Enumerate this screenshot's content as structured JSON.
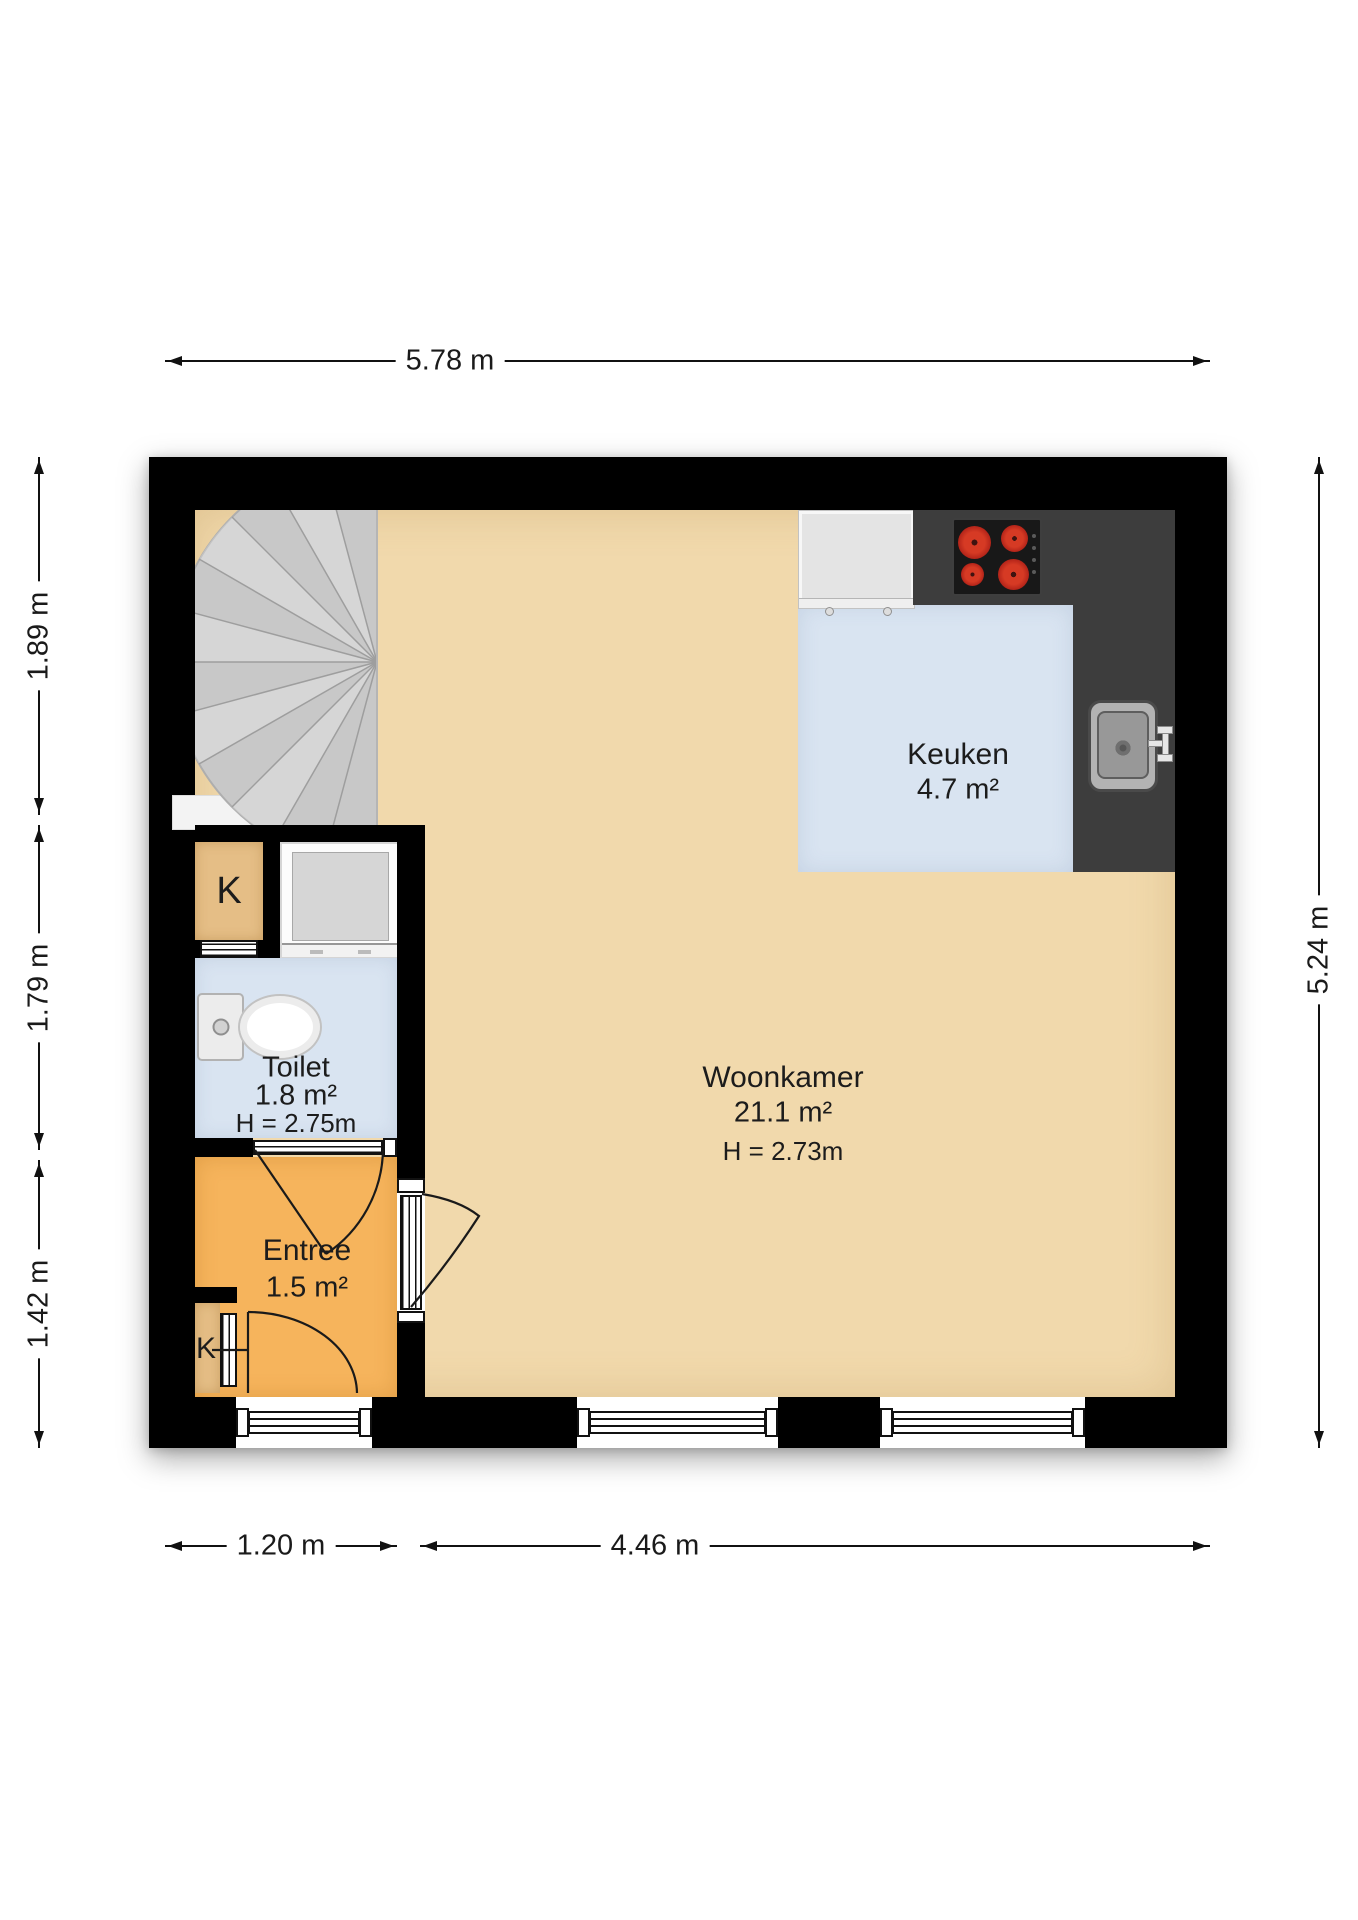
{
  "floorplan": {
    "rooms": {
      "woonkamer": {
        "name": "Woonkamer",
        "area": "21.1 m²",
        "ceiling": "H = 2.73m"
      },
      "keuken": {
        "name": "Keuken",
        "area": "4.7 m²"
      },
      "toilet": {
        "name": "Toilet",
        "area": "1.8 m²",
        "ceiling": "H = 2.75m"
      },
      "entree": {
        "name": "Entree",
        "area": "1.5 m²"
      },
      "closet": {
        "label": "K"
      },
      "meter_closet": {
        "label": "K"
      }
    },
    "dimensions": {
      "top_width": "5.78 m",
      "left_upper": "1.89 m",
      "left_middle": "1.79 m",
      "left_lower": "1.42 m",
      "right_height": "5.24 m",
      "bottom_left": "1.20 m",
      "bottom_right": "4.46 m"
    },
    "colors": {
      "wall": "#000000",
      "woonkamer_floor": "#f1d9ac",
      "keuken_floor": "#d9e4f1",
      "toilet_floor": "#d9e4f1",
      "entree_floor": "#f6b45c",
      "closet_floor": "#e5be86",
      "stairs": "#c8c8c8",
      "counter": "#3d3d3d",
      "burner": "#c3271c"
    }
  }
}
